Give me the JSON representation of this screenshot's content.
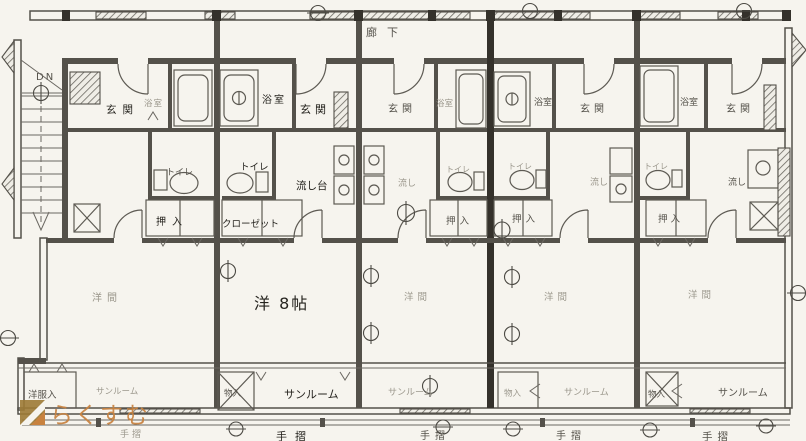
{
  "page": {
    "corridor": "廊下",
    "stairs_dn": "DN",
    "watermark": "らくすむ",
    "units": [
      {
        "genkan": "玄関",
        "bath": "浴室",
        "toilet": "トイレ",
        "closet": "押入",
        "room": "洋間",
        "wardrobe": "洋服入",
        "sunroom": "サンルーム",
        "handrail": "手摺"
      },
      {
        "genkan": "玄関",
        "bath": "浴室",
        "toilet": "トイレ",
        "sink": "流し台",
        "closet": "クローゼット",
        "storage": "物入",
        "room": "洋 8帖",
        "sunroom": "サンルーム",
        "handrail": "手摺"
      },
      {
        "genkan": "玄関",
        "bath": "浴室",
        "toilet": "トイレ",
        "sink": "流し",
        "closet": "押入",
        "room": "洋間",
        "sunroom": "サンルーム",
        "handrail": "手摺"
      },
      {
        "genkan": "玄関",
        "bath": "浴室",
        "toilet": "トイレ",
        "sink": "流し",
        "closet": "押入",
        "storage": "物入",
        "room": "洋間",
        "sunroom": "サンルーム",
        "handrail": "手摺"
      },
      {
        "genkan": "玄関",
        "bath": "浴室",
        "toilet": "トイレ",
        "sink": "流し",
        "closet": "押入",
        "storage": "物入",
        "room": "洋間",
        "sunroom": "サンルーム",
        "handrail": "手摺"
      }
    ],
    "colors": {
      "paper": "#f6f4ee",
      "line": "#54514a",
      "dark_text": "#26241f",
      "faint_text": "#9b978c",
      "watermark": "#c8823f"
    }
  }
}
